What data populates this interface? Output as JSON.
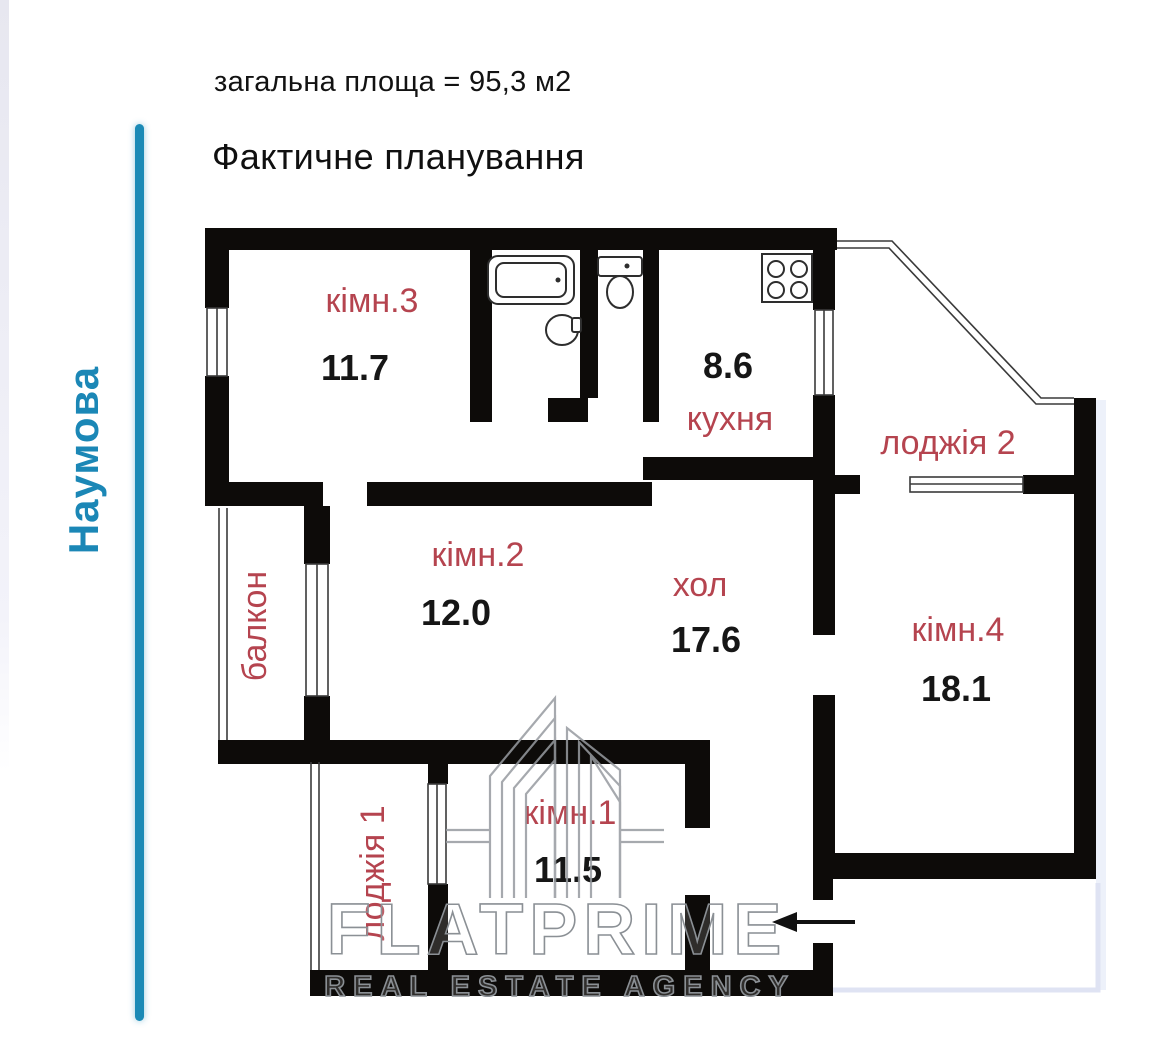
{
  "header": {
    "area_text": "загальна площа = 95,3 м2",
    "title": "Фактичне планування"
  },
  "street": {
    "name": "Наумова"
  },
  "plan": {
    "rooms": [
      {
        "key": "room3",
        "label": "кімн.3",
        "area": "11.7"
      },
      {
        "key": "kitchen",
        "label": "кухня",
        "area": "8.6"
      },
      {
        "key": "loggia2",
        "label": "лоджія 2",
        "area": ""
      },
      {
        "key": "room2",
        "label": "кімн.2",
        "area": "12.0"
      },
      {
        "key": "hall",
        "label": "хол",
        "area": "17.6"
      },
      {
        "key": "room4",
        "label": "кімн.4",
        "area": "18.1"
      },
      {
        "key": "balcony",
        "label": "балкон",
        "area": ""
      },
      {
        "key": "loggia1",
        "label": "лоджія 1",
        "area": ""
      },
      {
        "key": "room1",
        "label": "кімн.1",
        "area": "11.5"
      }
    ],
    "fixtures": [
      "bathtub",
      "sink",
      "toilet",
      "stove"
    ],
    "entrance_arrow_direction": "left"
  },
  "watermark": {
    "brand": "FLATPRIME",
    "tagline": "REAL ESTATE AGENCY"
  },
  "colors": {
    "accent_blue": "#1b8ab6",
    "street_text_blue": "#1b87b6",
    "room_label_red": "#b5444f",
    "wall_black": "#0d0b09",
    "watermark_gray": "#8b9095"
  }
}
